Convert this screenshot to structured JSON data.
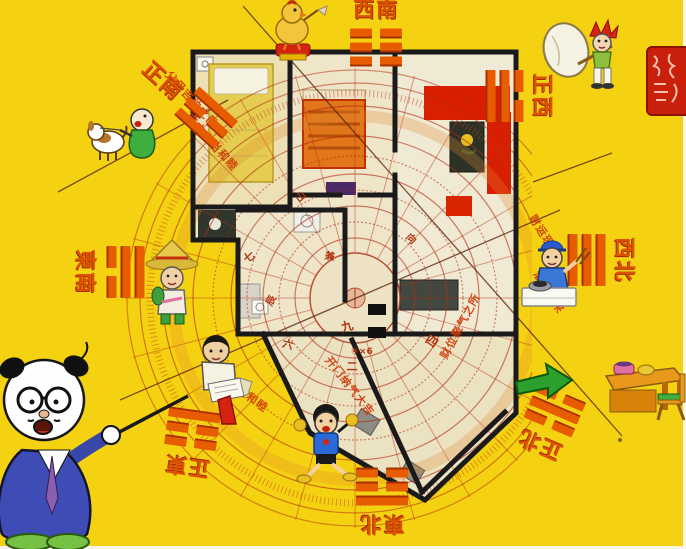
{
  "colors": {
    "background": "#f5d211",
    "label_orange": "#dd5200",
    "compass_red": "#b22c10",
    "wall_black": "#1a1a1a",
    "seal_red": "#c8200a",
    "arrow_green": "#2ca02c"
  },
  "direction_labels": [
    {
      "id": "south",
      "text": "正南",
      "trigram": [
        "s",
        "b",
        "s"
      ]
    },
    {
      "id": "southwest",
      "text": "西南",
      "trigram": [
        "b",
        "b",
        "b"
      ]
    },
    {
      "id": "west",
      "text": "正西",
      "trigram": [
        "b",
        "s",
        "s"
      ]
    },
    {
      "id": "northwest",
      "text": "西北",
      "trigram": [
        "s",
        "s",
        "s"
      ]
    },
    {
      "id": "north",
      "text": "正北",
      "trigram": [
        "b",
        "s",
        "b"
      ]
    },
    {
      "id": "northeast",
      "text": "東北",
      "trigram": [
        "s",
        "b",
        "b"
      ]
    },
    {
      "id": "east",
      "text": "正東",
      "trigram": [
        "b",
        "b",
        "s"
      ]
    },
    {
      "id": "southeast",
      "text": "東南",
      "trigram": [
        "s",
        "s",
        "b"
      ]
    }
  ],
  "annotations": [
    {
      "text": "父母吉位之卧室",
      "x": 196,
      "y": 104,
      "rot": 48,
      "size": 11
    },
    {
      "text": "南方交当和睦",
      "x": 212,
      "y": 142,
      "rot": 48,
      "size": 11
    },
    {
      "text": "财运现象",
      "x": 545,
      "y": 236,
      "rot": 58,
      "size": 11
    },
    {
      "text": "滚滚到来",
      "x": 549,
      "y": 292,
      "rot": 58,
      "size": 11
    },
    {
      "text": "人丁兴旺和睦",
      "x": 238,
      "y": 388,
      "rot": 36,
      "size": 11
    },
    {
      "text": "财位聚气之所",
      "x": 460,
      "y": 326,
      "rot": -62,
      "size": 11
    },
    {
      "text": "开门纳气大吉",
      "x": 350,
      "y": 386,
      "rot": 52,
      "size": 11
    }
  ],
  "compass": {
    "ring_glyphs": [
      {
        "t": "九",
        "x": 347,
        "y": 326,
        "r": -15,
        "size": 12
      },
      {
        "t": "四",
        "x": 432,
        "y": 341,
        "r": 35,
        "size": 12
      },
      {
        "t": "二",
        "x": 352,
        "y": 366,
        "r": 0,
        "size": 11
      },
      {
        "t": "七",
        "x": 249,
        "y": 257,
        "r": -35,
        "size": 11
      },
      {
        "t": "六",
        "x": 288,
        "y": 344,
        "r": 15,
        "size": 11
      },
      {
        "t": "④×6",
        "x": 362,
        "y": 352,
        "r": 0,
        "size": 9
      },
      {
        "t": "山",
        "x": 300,
        "y": 196,
        "r": -40,
        "size": 10
      },
      {
        "t": "向",
        "x": 412,
        "y": 238,
        "r": 45,
        "size": 10
      },
      {
        "t": "辰",
        "x": 270,
        "y": 300,
        "r": -60,
        "size": 10
      },
      {
        "t": "兼",
        "x": 330,
        "y": 255,
        "r": 10,
        "size": 10
      }
    ]
  },
  "figures": [
    {
      "name": "professor-pointer",
      "desc": "cartoon professor in blue suit pointing a stick"
    },
    {
      "name": "dog-walker",
      "desc": "green-robed figure with white dog"
    },
    {
      "name": "chick-on-stool",
      "desc": "yellow chick sitting on red stool"
    },
    {
      "name": "sack-carrier",
      "desc": "red-haired kid carrying white sack on stick"
    },
    {
      "name": "farmer-straw-hat",
      "desc": "figure wearing straw hat"
    },
    {
      "name": "worker-at-counter",
      "desc": "blue-capped worker at white counter with pot"
    },
    {
      "name": "reading-man",
      "desc": "man with fanned book and red wedge"
    },
    {
      "name": "jumping-boy",
      "desc": "boy in blue shirt jumping"
    },
    {
      "name": "desk-with-arrow",
      "desc": "green arrow pointing at orange desk and chair"
    },
    {
      "name": "seal-stamp",
      "desc": "red square seal"
    }
  ]
}
